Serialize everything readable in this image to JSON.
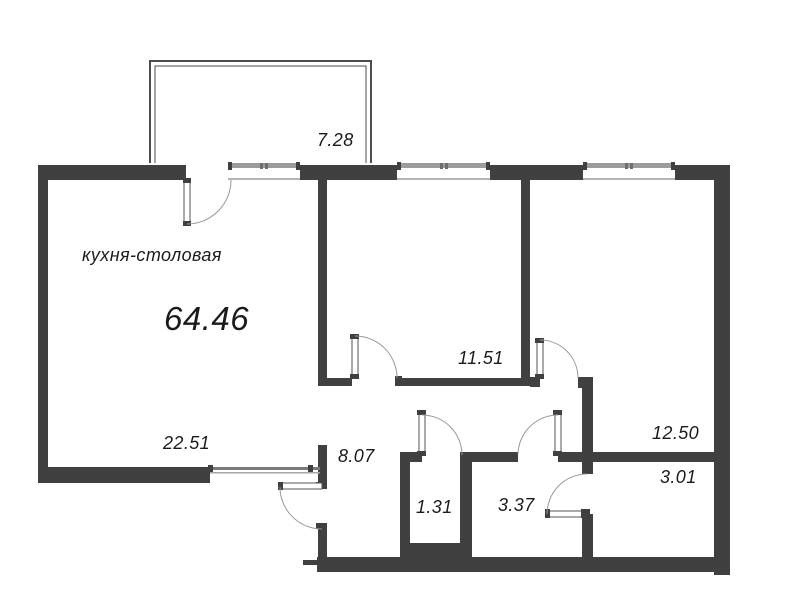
{
  "plan": {
    "type": "apartment-floor-plan",
    "rooms": [
      {
        "key": "balcony",
        "area": "7.28"
      },
      {
        "key": "kitchen-dining",
        "label": "кухня-столовая",
        "area": "22.51"
      },
      {
        "key": "apartment-total",
        "area": "64.46"
      },
      {
        "key": "living-room",
        "area": "11.51"
      },
      {
        "key": "bedroom",
        "area": "12.50"
      },
      {
        "key": "hallway",
        "area": "8.07"
      },
      {
        "key": "wc",
        "area": "1.31"
      },
      {
        "key": "bathroom",
        "area": "3.37"
      },
      {
        "key": "storage",
        "area": "3.01"
      }
    ],
    "colors": {
      "wall": "#404040",
      "window_frame": "#9c9c9c",
      "door_arc": "#999999",
      "balcony_line": "#4c4c4c",
      "text": "#1b1b1b",
      "background": "#ffffff"
    }
  }
}
